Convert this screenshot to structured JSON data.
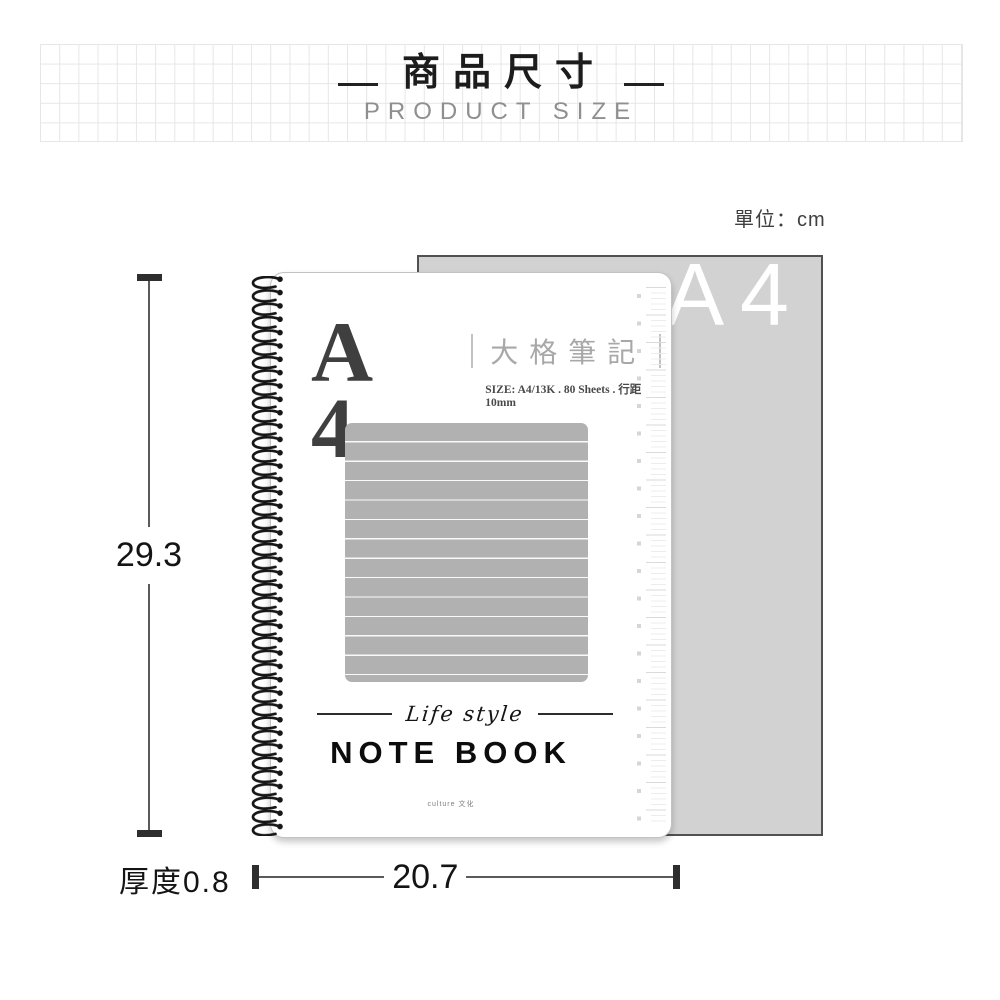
{
  "header": {
    "title": "商品尺寸",
    "subtitle": "PRODUCT SIZE"
  },
  "unit_note": "單位：cm",
  "sheet": {
    "size_label": "A4"
  },
  "notebook": {
    "cover_size": "A 4",
    "cover_title": "大格筆記",
    "cover_spec": "SIZE: A4/13K . 80 Sheets . 行距10mm",
    "divider_script": "Life style",
    "product_name": "NOTE BOOK",
    "brand_mark": "culture 文化"
  },
  "dimensions": {
    "height_cm": "29.3",
    "width_cm": "20.7",
    "thickness": "厚度0.8"
  },
  "colors": {
    "sheet_gray": "#d2d2d2",
    "ruled_block_gray": "#b1b1b1",
    "dimension_dark": "#2e2e2e",
    "grid_line": "#e6e6e6"
  }
}
